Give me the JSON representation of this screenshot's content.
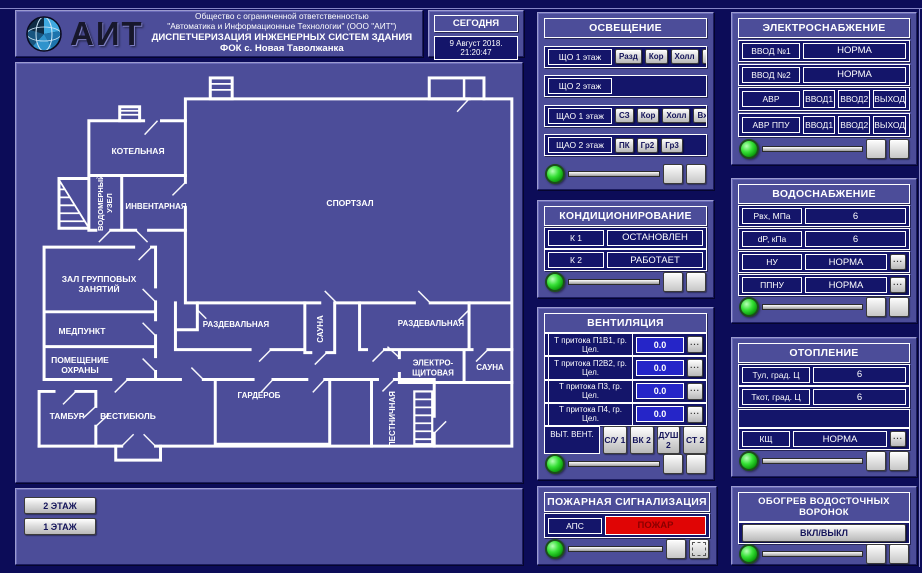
{
  "header": {
    "logo": "АИТ",
    "line1": "Общество с ограниченной ответственностью",
    "line2": "\"Автоматика и Информационные Технологии\" (ООО \"АИТ\")",
    "line3": "ДИСПЕТЧЕРИЗАЦИЯ ИНЖЕНЕРНЫХ СИСТЕМ ЗДАНИЯ",
    "line4": "ФОК с. Новая Таволжанка",
    "today_label": "СЕГОДНЯ",
    "datetime": "9 Август 2018. 21:20:47"
  },
  "ui": {
    "more": "..."
  },
  "floors": {
    "floor2": "2 ЭТАЖ",
    "floor1": "1 ЭТАЖ"
  },
  "floorplan": {
    "rooms": [
      {
        "label": "КОТЕЛЬНАЯ"
      },
      {
        "label": "ВОДОМЕРНЫЙ УЗЕЛ"
      },
      {
        "label": "ИНВЕНТАРНАЯ"
      },
      {
        "label": "СПОРТЗАЛ"
      },
      {
        "label": "ЗАЛ ГРУППОВЫХ ЗАНЯТИЙ"
      },
      {
        "label": "МЕДПУНКТ"
      },
      {
        "label": "ПОМЕЩЕНИЕ ОХРАНЫ"
      },
      {
        "label": "ТАМБУР"
      },
      {
        "label": "ВЕСТИБЮЛЬ"
      },
      {
        "label": "РАЗДЕВАЛЬНАЯ"
      },
      {
        "label": "САУНА"
      },
      {
        "label": "РАЗДЕВАЛЬНАЯ"
      },
      {
        "label": "ЭЛЕКТРО-ЩИТОВАЯ"
      },
      {
        "label": "САУНА"
      },
      {
        "label": "ГАРДЕРОБ"
      },
      {
        "label": "ЛЕСТНИЧНАЯ"
      }
    ]
  },
  "lighting": {
    "title": "ОСВЕЩЕНИЕ",
    "rows": [
      {
        "label": "ЩО 1 этаж",
        "buttons": [
          "Разд",
          "Кор",
          "Холл",
          "СЗ 2",
          "СЗ 3",
          "СЗ 1э"
        ]
      },
      {
        "label": "ЩО 2 этаж",
        "buttons": []
      },
      {
        "label": "ЩАО 1 этаж",
        "buttons": [
          "СЗ",
          "Кор",
          "Холл",
          "Вх"
        ]
      },
      {
        "label": "ЩАО 2 этаж",
        "buttons": [
          "ПК",
          "Гр2",
          "Гр3"
        ]
      }
    ]
  },
  "power": {
    "title": "ЭЛЕКТРОСНАБЖЕНИЕ",
    "rows": [
      {
        "label": "ВВОД №1",
        "value": "НОРМА"
      },
      {
        "label": "ВВОД №2",
        "value": "НОРМА"
      },
      {
        "label": "АВР",
        "cells": [
          "ВВОД1",
          "ВВОД2",
          "ВЫХОД"
        ]
      },
      {
        "label": "АВР ППУ",
        "cells": [
          "ВВОД1",
          "ВВОД2",
          "ВЫХОД"
        ]
      }
    ]
  },
  "hvac": {
    "title": "КОНДИЦИОНИРОВАНИЕ",
    "rows": [
      {
        "label": "К 1",
        "value": "ОСТАНОВЛЕН"
      },
      {
        "label": "К 2",
        "value": "РАБОТАЕТ"
      }
    ]
  },
  "water": {
    "title": "ВОДОСНАБЖЕНИЕ",
    "rows": [
      {
        "label": "Рвх, МПа",
        "value": "6"
      },
      {
        "label": "dP, кПа",
        "value": "6"
      },
      {
        "label": "НУ",
        "value": "НОРМА"
      },
      {
        "label": "ППНУ",
        "value": "НОРМА"
      }
    ]
  },
  "ventilation": {
    "title": "ВЕНТИЛЯЦИЯ",
    "rows": [
      {
        "label": "Т притока П1В1, гр. Цел.",
        "value": "0.0"
      },
      {
        "label": "Т притока П2В2, гр. Цел.",
        "value": "0.0"
      },
      {
        "label": "Т притока П3, гр. Цел.",
        "value": "0.0"
      },
      {
        "label": "Т притока П4, гр. Цел.",
        "value": "0.0"
      }
    ],
    "exhaust": {
      "label": "ВЫТ. ВЕНТ.",
      "buttons": [
        "С/У 1",
        "ВК 2",
        "ДУШ 2",
        "СТ 2"
      ]
    }
  },
  "heating": {
    "title": "ОТОПЛЕНИЕ",
    "rows": [
      {
        "label": "Тул, град. Ц",
        "value": "6"
      },
      {
        "label": "Ткот, град. Ц",
        "value": "6"
      },
      {
        "label": "КЩ",
        "value": "НОРМА"
      }
    ]
  },
  "fire": {
    "title": "ПОЖАРНАЯ СИГНАЛИЗАЦИЯ",
    "label": "АПС",
    "status": "ПОЖАР",
    "alarm_color": "#e00505"
  },
  "drain": {
    "title": "ОБОГРЕВ ВОДОСТОЧНЫХ ВОРОНОК",
    "button": "ВКЛ/ВЫКЛ"
  },
  "colors": {
    "background": "#0c0c58",
    "panel": "#4c4d99",
    "field": "#14156a",
    "value_blue": "#2525c8",
    "alarm_red": "#e00505",
    "led_green": "#2ecc2e"
  }
}
